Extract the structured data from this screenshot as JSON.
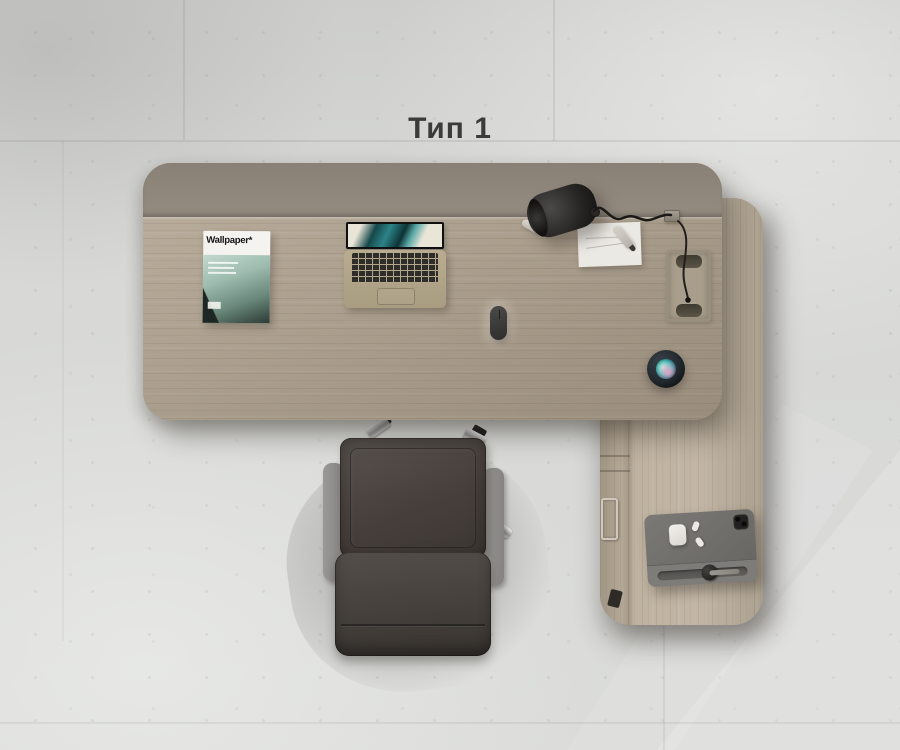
{
  "page": {
    "title": "Тип 1"
  },
  "desk_items": {
    "magazine_masthead": "Wallpaper*"
  },
  "objects": [
    "main-desk",
    "modesty-panel",
    "return-cabinet",
    "drawer-handle",
    "magazine",
    "laptop",
    "desk-lamp",
    "lamp-clamp",
    "paper-sheet",
    "pen",
    "marker-pen",
    "cable-grommet",
    "power-cable",
    "computer-mouse",
    "smart-speaker",
    "office-chair",
    "tablet-with-keyboard",
    "airpods-case",
    "apple-pencil",
    "concrete-tile-floor"
  ],
  "colors": {
    "floor": "#d6d7d5",
    "desk_wood": "#b2a593",
    "return_wood": "#beb2a0",
    "modesty_panel": "#8d8479",
    "chair_leather": "#453f3b",
    "chair_armrest": "#908e8c",
    "lamp_black": "#242220",
    "speaker_glow_teal": "#4cc7ba",
    "speaker_glow_pink": "#eba5c8",
    "tablet_case": "#72706d",
    "magazine_red_accent": "#b8453a",
    "title_text": "#3b3b3b"
  }
}
